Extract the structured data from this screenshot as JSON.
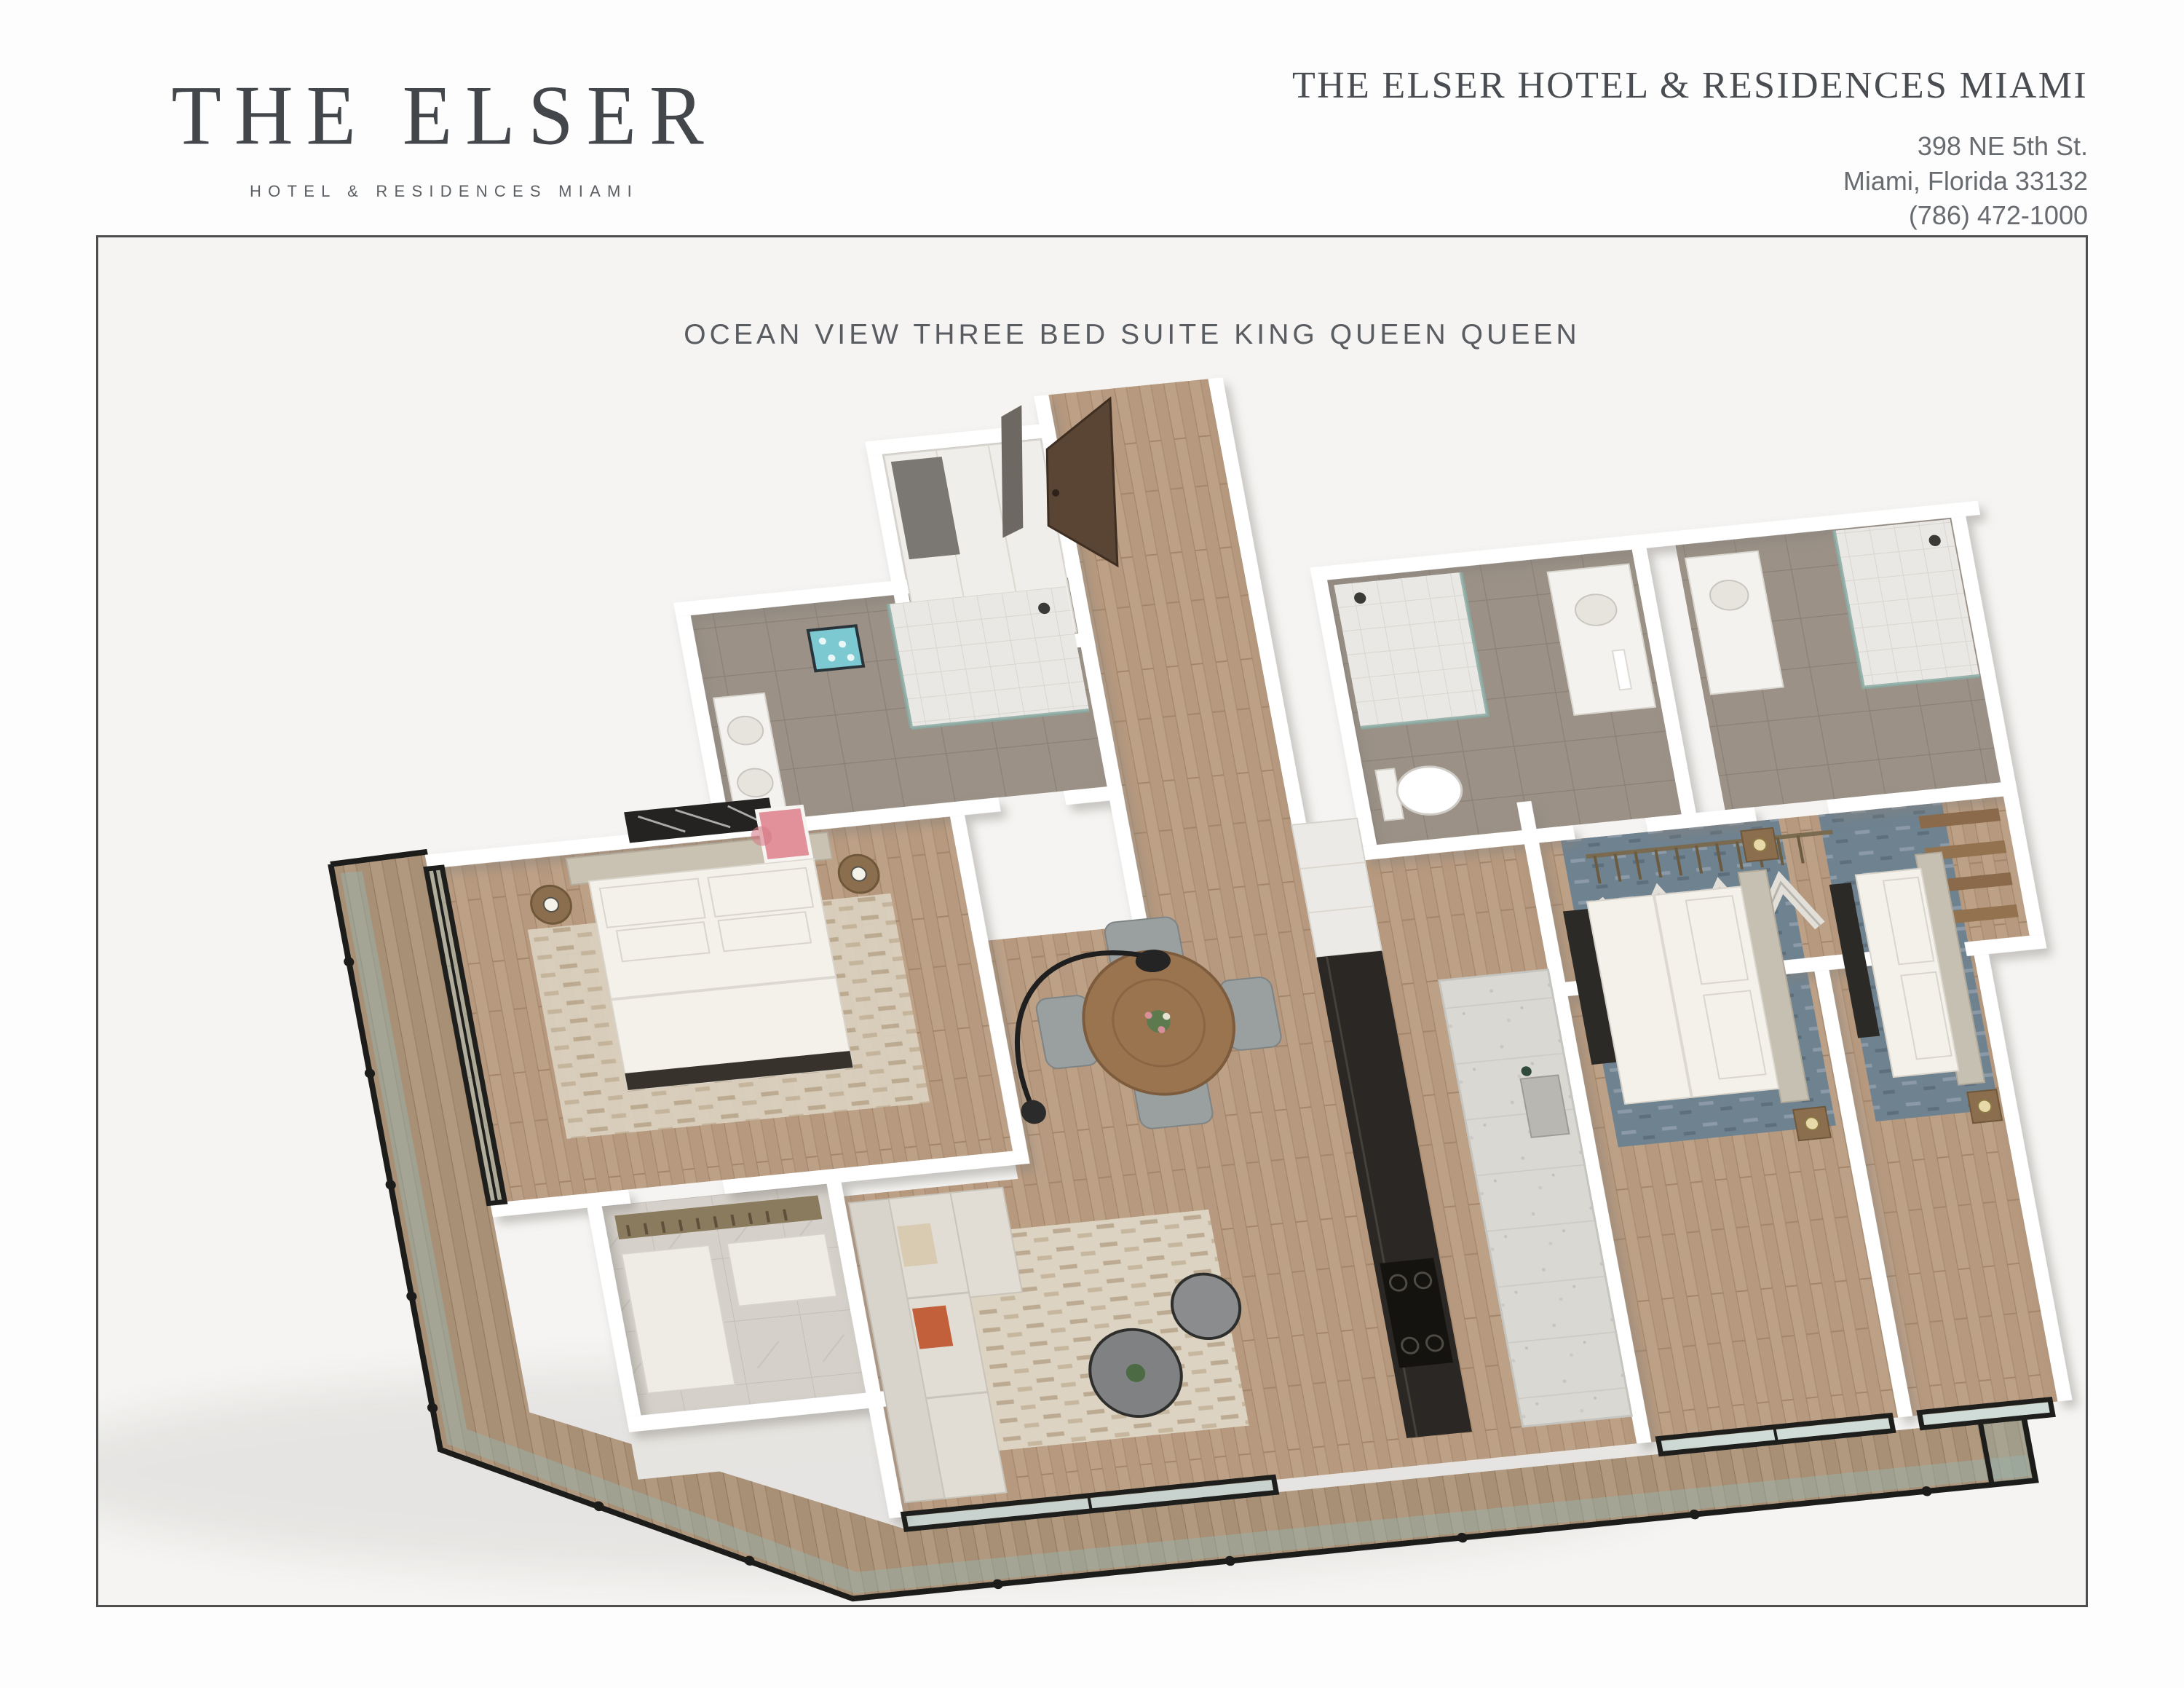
{
  "brand": {
    "logo_title": "THE ELSER",
    "logo_subtitle": "HOTEL & RESIDENCES MIAMI"
  },
  "contact": {
    "hotel_name": "THE ELSER HOTEL & RESIDENCES MIAMI",
    "address_line1": "398 NE 5th St.",
    "address_line2": "Miami, Florida 33132",
    "phone": "(786) 472-1000"
  },
  "sheet": {
    "title": "OCEAN VIEW THREE BED SUITE KING QUEEN QUEEN"
  },
  "palette": {
    "page_background": "#fdfdfd",
    "panel_background": "#f5f4f2",
    "panel_border": "#4e4e4e",
    "heading_text": "#494d51",
    "body_text": "#686c70",
    "wall_white": "#ffffff",
    "wood_floor": "#bda187",
    "balcony_deck": "#b29a82",
    "bathroom_tile": "#9b9186",
    "shower_tile": "#eae8e4",
    "entry_door_brown": "#5a4433",
    "window_frame_black": "#1e1e1c",
    "railing_glass": "#98b2ab",
    "bedding_white": "#f4f1ea",
    "headboard_taupe": "#c9c2b2",
    "rug_beige": "#dcd3c2",
    "rug_blue_grey": "#6f8290",
    "sofa_grey": "#d8d4cb",
    "accent_orange": "#c1603a",
    "kitchen_island_stone": "#dad8d2",
    "counter_black": "#2a2724",
    "dining_table_wood": "#9a744f",
    "art_pink": "#e2909a",
    "art_teal": "#7cc9d2"
  }
}
